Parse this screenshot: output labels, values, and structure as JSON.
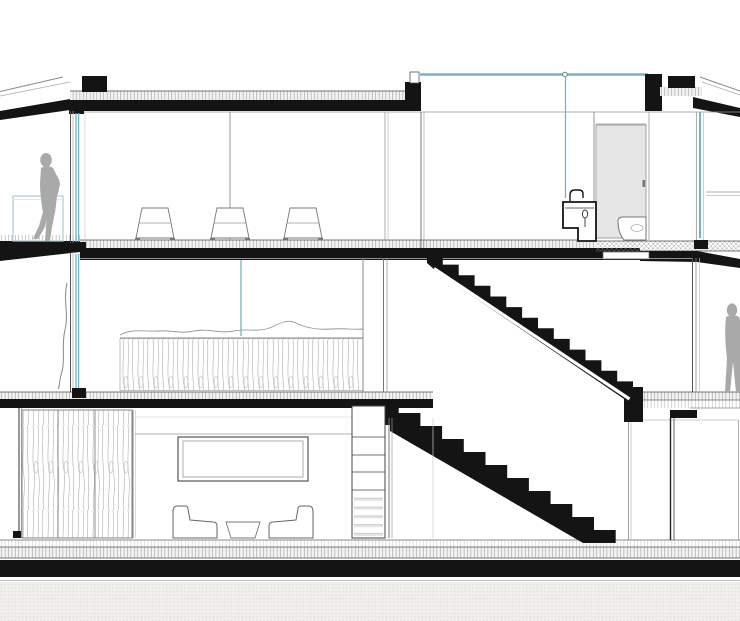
{
  "meta": {
    "description": "Black and white architectural cross-section drawing of a three storey house with staircase, bathroom, bedroom, living room and two human figures",
    "drawing_type": "building section",
    "visible_text": ""
  },
  "colors": {
    "background": "#ffffff",
    "ink": "#141414",
    "line_gray": "#8a8a8a",
    "figure_gray": "#a9a9a9",
    "glass_blue": "#74b4c4",
    "railing_blue": "#a8cdd6",
    "door_gray": "#e6e6e6",
    "ground_fill": "#f1efec",
    "grain_line": "#b8b8b8"
  },
  "scene": {
    "floors": [
      {
        "name": "upper-floor",
        "elements": [
          "left balcony with glass railing",
          "walking person",
          "three bar stools",
          "glass skylight roof",
          "bathroom with sink, toilet and shower panel",
          "roof parapet blocks"
        ]
      },
      {
        "name": "middle-floor",
        "elements": [
          "bedroom with bed and wood panel base",
          "curtain",
          "upper stair flight descending right",
          "terrace with standing person",
          "glass sliding doors"
        ]
      },
      {
        "name": "ground-floor",
        "elements": [
          "wood grain wardrobe wall",
          "recessed TV niche",
          "two armchairs with coffee table",
          "shelf ladder unit",
          "lower stair flight",
          "right storage room"
        ]
      }
    ],
    "counts": {
      "bar_stools": 3,
      "upper_stair_steps": 13,
      "lower_stair_steps": 11,
      "figures": 2,
      "armchairs": 2
    }
  }
}
